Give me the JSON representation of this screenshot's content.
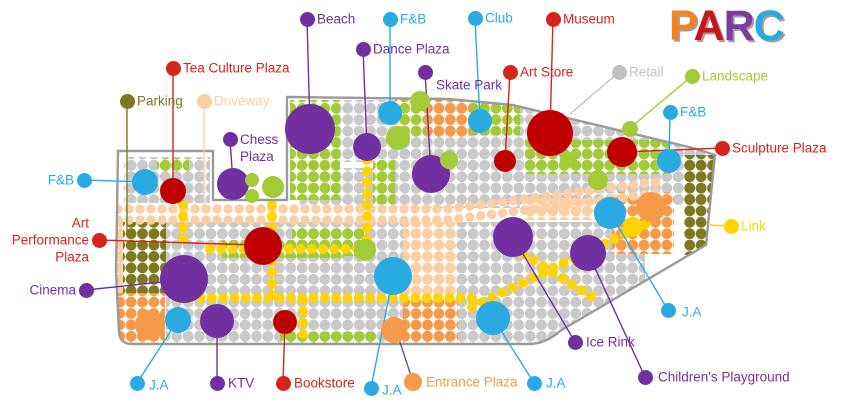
{
  "page": {
    "width": 850,
    "height": 406,
    "background": "#ffffff"
  },
  "logo": {
    "title": "PARC",
    "letters": [
      {
        "ch": "P",
        "color": "#f58220"
      },
      {
        "ch": "A",
        "color": "#c4161c"
      },
      {
        "ch": "R",
        "color": "#7a3c9f"
      },
      {
        "ch": "C",
        "color": "#29abe2"
      }
    ]
  },
  "palette": {
    "purple": "#7030a0",
    "blue": "#29abe2",
    "red": "#d6231d",
    "darkred": "#c00000",
    "olive": "#7d791e",
    "peach": "#fbcfa4",
    "orange": "#f59a49",
    "gray": "#c9c9c9",
    "graytext": "#c1c1c1",
    "green": "#a2cb37",
    "yellow": "#ffd400",
    "outline": "#9b9b9b",
    "slate": "#5c5c8e"
  },
  "map": {
    "outline_path": "M287,97 L448,99 L513,105 L693,148 L715,155 L706,245 L560,331 Q546,344 528,344 L132,344 Q120,344 119,332 L116,272 L118,151 L213,151 L213,200 L287,200 Z",
    "regions": [
      {
        "c": "gray",
        "r": [
          124,
          157,
          86,
          46
        ]
      },
      {
        "c": "gray",
        "r": [
          337,
          100,
          60,
          62
        ]
      },
      {
        "c": "gray",
        "r": [
          300,
          168,
          96,
          38
        ]
      },
      {
        "c": "gray",
        "r": [
          395,
          133,
          125,
          75
        ]
      },
      {
        "c": "gray",
        "r": [
          520,
          95,
          185,
          110
        ]
      },
      {
        "c": "gray",
        "r": [
          166,
          222,
          80,
          122
        ]
      },
      {
        "c": "gray",
        "r": [
          246,
          222,
          157,
          40
        ]
      },
      {
        "c": "gray",
        "r": [
          362,
          258,
          42,
          86
        ]
      },
      {
        "c": "gray",
        "r": [
          244,
          258,
          158,
          86
        ]
      },
      {
        "c": "gray",
        "r": [
          455,
          222,
          190,
          122
        ]
      },
      {
        "c": "green",
        "r": [
          290,
          100,
          50,
          100
        ]
      },
      {
        "c": "green",
        "r": [
          157,
          158,
          32,
          14
        ]
      },
      {
        "c": "green",
        "r": [
          395,
          95,
          30,
          42
        ]
      },
      {
        "c": "green",
        "r": [
          470,
          97,
          50,
          38
        ]
      },
      {
        "c": "green",
        "r": [
          525,
          140,
          145,
          34
        ]
      },
      {
        "c": "green",
        "r": [
          373,
          160,
          22,
          44
        ]
      },
      {
        "c": "green",
        "r": [
          292,
          228,
          72,
          28
        ]
      },
      {
        "c": "green",
        "r": [
          222,
          240,
          122,
          18
        ]
      },
      {
        "c": "green",
        "r": [
          280,
          332,
          96,
          12
        ]
      },
      {
        "c": "olive",
        "r": [
          120,
          222,
          46,
          72
        ]
      },
      {
        "c": "olive",
        "r": [
          684,
          155,
          33,
          100
        ]
      },
      {
        "c": "peach",
        "r": [
          403,
          222,
          54,
          80
        ]
      },
      {
        "c": "peach",
        "r": [
          525,
          198,
          85,
          22
        ]
      },
      {
        "c": "peach",
        "r": [
          97,
          222,
          26,
          72
        ]
      },
      {
        "c": "orange",
        "r": [
          425,
          95,
          46,
          42
        ]
      },
      {
        "c": "orange",
        "r": [
          403,
          300,
          55,
          44
        ]
      },
      {
        "c": "orange",
        "r": [
          612,
          192,
          62,
          62
        ]
      },
      {
        "c": "orange",
        "r": [
          110,
          293,
          55,
          52
        ]
      }
    ],
    "driveway_paths": [
      {
        "d": "M118,209 L448,209 L663,181",
        "w": 9.5
      },
      {
        "d": "M118,220 L448,220 L665,192",
        "w": 9.5
      }
    ],
    "road_paths": [
      {
        "d": "M178,298 H472",
        "w": 10
      },
      {
        "d": "M210,249 H364",
        "w": 10
      },
      {
        "d": "M367,160 V258",
        "w": 10
      },
      {
        "d": "M272,205 V300",
        "w": 10
      },
      {
        "d": "M183,205 V250",
        "w": 10
      },
      {
        "d": "M303,300 V340",
        "w": 10
      },
      {
        "d": "M472,307 L648,223",
        "w": 10
      },
      {
        "d": "M505,242 L600,302",
        "w": 10
      }
    ],
    "markers": [
      {
        "n": "beach-circle",
        "c": "purple",
        "x": 310,
        "y": 129,
        "r": 25
      },
      {
        "n": "dance-plaza-circle",
        "c": "purple",
        "x": 367,
        "y": 147,
        "r": 14
      },
      {
        "n": "skate-park-circle",
        "c": "purple",
        "x": 431,
        "y": 174,
        "r": 19
      },
      {
        "n": "chess-plaza-circle",
        "c": "purple",
        "x": 233,
        "y": 184,
        "r": 16
      },
      {
        "n": "cinema-circle",
        "c": "purple",
        "x": 184,
        "y": 279,
        "r": 24
      },
      {
        "n": "ktv-circle",
        "c": "purple",
        "x": 217,
        "y": 321,
        "r": 17
      },
      {
        "n": "ice-rink-circle",
        "c": "purple",
        "x": 513,
        "y": 237,
        "r": 20
      },
      {
        "n": "childrens-playground-circle",
        "c": "purple",
        "x": 588,
        "y": 253,
        "r": 18
      },
      {
        "n": "green-circle",
        "c": "green",
        "x": 398,
        "y": 138,
        "r": 12
      },
      {
        "n": "green-circle",
        "c": "green",
        "x": 449,
        "y": 160,
        "r": 9
      },
      {
        "n": "green-circle",
        "c": "green",
        "x": 420,
        "y": 101,
        "r": 10
      },
      {
        "n": "green-circle",
        "c": "green",
        "x": 365,
        "y": 250,
        "r": 11
      },
      {
        "n": "green-circle",
        "c": "green",
        "x": 252,
        "y": 180,
        "r": 7
      },
      {
        "n": "green-circle",
        "c": "green",
        "x": 252,
        "y": 196,
        "r": 7
      },
      {
        "n": "green-circle",
        "c": "green",
        "x": 273,
        "y": 187,
        "r": 11
      },
      {
        "n": "green-circle",
        "c": "green",
        "x": 630,
        "y": 129,
        "r": 8
      },
      {
        "n": "green-circle",
        "c": "green",
        "x": 598,
        "y": 180,
        "r": 10
      },
      {
        "n": "green-circle",
        "c": "green",
        "x": 568,
        "y": 160,
        "r": 8
      },
      {
        "n": "museum-circle",
        "c": "darkred",
        "x": 550,
        "y": 133,
        "r": 23
      },
      {
        "n": "tea-culture-circle",
        "c": "darkred",
        "x": 173,
        "y": 191,
        "r": 13
      },
      {
        "n": "art-store-circle",
        "c": "darkred",
        "x": 505,
        "y": 161,
        "r": 11
      },
      {
        "n": "sculpture-circle",
        "c": "darkred",
        "x": 622,
        "y": 152,
        "r": 15
      },
      {
        "n": "art-performance-circle",
        "c": "darkred",
        "x": 263,
        "y": 246,
        "r": 19
      },
      {
        "n": "bookstore-circle",
        "c": "darkred",
        "x": 285,
        "y": 322,
        "r": 12
      },
      {
        "n": "entrance-circle",
        "c": "orange",
        "x": 394,
        "y": 330,
        "r": 13
      },
      {
        "n": "orange-circle",
        "c": "orange",
        "x": 651,
        "y": 207,
        "r": 15
      },
      {
        "n": "orange-circle",
        "c": "orange",
        "x": 150,
        "y": 325,
        "r": 15
      },
      {
        "n": "link-circle",
        "c": "yellow",
        "x": 633,
        "y": 227,
        "r": 10
      },
      {
        "n": "fnb-top-circle",
        "c": "blue",
        "x": 390,
        "y": 113,
        "r": 12
      },
      {
        "n": "club-circle",
        "c": "blue",
        "x": 480,
        "y": 121,
        "r": 12
      },
      {
        "n": "fnb-left-circle",
        "c": "blue",
        "x": 145,
        "y": 182,
        "r": 13
      },
      {
        "n": "fnb-right-circle",
        "c": "blue",
        "x": 669,
        "y": 161,
        "r": 12
      },
      {
        "n": "ja-circle",
        "c": "blue",
        "x": 178,
        "y": 320,
        "r": 13
      },
      {
        "n": "ja-circle",
        "c": "blue",
        "x": 393,
        "y": 276,
        "r": 19
      },
      {
        "n": "ja-circle",
        "c": "blue",
        "x": 493,
        "y": 318,
        "r": 17
      },
      {
        "n": "ja-circle",
        "c": "blue",
        "x": 610,
        "y": 213,
        "r": 16
      }
    ],
    "labels": [
      {
        "id": "beach",
        "lines": [
          "Beach"
        ],
        "color": "purple",
        "dot": [
          307,
          19
        ],
        "tx": 317,
        "ty": 19,
        "align": "left",
        "target": [
          310,
          129
        ]
      },
      {
        "id": "fnb-top",
        "lines": [
          "F&B"
        ],
        "color": "blue",
        "dot": [
          390,
          19
        ],
        "tx": 400,
        "ty": 19,
        "align": "left",
        "target": [
          390,
          113
        ]
      },
      {
        "id": "club",
        "lines": [
          "Club"
        ],
        "color": "blue",
        "dot": [
          475,
          18
        ],
        "tx": 485,
        "ty": 18,
        "align": "left",
        "target": [
          480,
          121
        ]
      },
      {
        "id": "museum",
        "lines": [
          "Museum"
        ],
        "color": "red",
        "dot": [
          553,
          19
        ],
        "tx": 563,
        "ty": 19,
        "align": "left",
        "target": [
          550,
          133
        ]
      },
      {
        "id": "dance-plaza",
        "lines": [
          "Dance Plaza"
        ],
        "color": "purple",
        "dot": [
          363,
          49
        ],
        "tx": 373,
        "ty": 49,
        "align": "left",
        "target": [
          367,
          147
        ]
      },
      {
        "id": "skate-park",
        "lines": [
          "Skate Park"
        ],
        "color": "purple",
        "dot": [
          425,
          72
        ],
        "tx": 436,
        "ty": 85,
        "align": "left",
        "target": [
          431,
          174
        ]
      },
      {
        "id": "tea-culture-plaza",
        "lines": [
          "Tea Culture Plaza"
        ],
        "color": "red",
        "dot": [
          173,
          68
        ],
        "tx": 183,
        "ty": 68,
        "align": "left",
        "target": [
          173,
          190
        ]
      },
      {
        "id": "art-store",
        "lines": [
          "Art Store"
        ],
        "color": "red",
        "dot": [
          510,
          72
        ],
        "tx": 520,
        "ty": 72,
        "align": "left",
        "target": [
          505,
          161
        ]
      },
      {
        "id": "parking",
        "lines": [
          "Parking"
        ],
        "color": "olive",
        "dot": [
          127,
          101
        ],
        "tx": 137,
        "ty": 101,
        "align": "left",
        "target": [
          127,
          235
        ]
      },
      {
        "id": "driveway",
        "lines": [
          "Driveway"
        ],
        "color": "peach",
        "dot": [
          204,
          101
        ],
        "tx": 214,
        "ty": 101,
        "align": "left",
        "target": [
          204,
          213
        ]
      },
      {
        "id": "chess-plaza",
        "lines": [
          "Chess",
          "Plaza"
        ],
        "color": "purple",
        "dot": [
          230,
          139
        ],
        "tx": 240,
        "ty": 148,
        "align": "left",
        "target": [
          233,
          183
        ]
      },
      {
        "id": "retail",
        "lines": [
          "Retail"
        ],
        "color": "graytext",
        "dot": [
          619,
          72
        ],
        "tx": 629,
        "ty": 72,
        "align": "left",
        "target": [
          570,
          114
        ]
      },
      {
        "id": "landscape",
        "lines": [
          "Landscape"
        ],
        "color": "green",
        "dot": [
          692,
          76
        ],
        "tx": 702,
        "ty": 76,
        "align": "left",
        "target": [
          630,
          128
        ]
      },
      {
        "id": "fnb-right",
        "lines": [
          "F&B"
        ],
        "color": "blue",
        "dot": [
          670,
          112
        ],
        "tx": 680,
        "ty": 112,
        "align": "left",
        "target": [
          669,
          160
        ]
      },
      {
        "id": "sculpture-plaza",
        "lines": [
          "Sculpture Plaza"
        ],
        "color": "red",
        "dot": [
          722,
          148
        ],
        "tx": 732,
        "ty": 148,
        "align": "left",
        "target": [
          624,
          152
        ]
      },
      {
        "id": "fnb-left",
        "lines": [
          "F&B"
        ],
        "color": "blue",
        "dot": [
          84,
          180
        ],
        "tx": 74,
        "ty": 180,
        "align": "right",
        "target": [
          145,
          182
        ]
      },
      {
        "id": "art-performance-plaza",
        "lines": [
          "Art",
          "Performance",
          "Plaza"
        ],
        "color": "red",
        "dot": [
          99,
          240
        ],
        "tx": 89,
        "ty": 240,
        "align": "right",
        "target": [
          255,
          245
        ]
      },
      {
        "id": "cinema",
        "lines": [
          "Cinema"
        ],
        "color": "purple",
        "dot": [
          86,
          290
        ],
        "tx": 76,
        "ty": 290,
        "align": "right",
        "target": [
          180,
          280
        ]
      },
      {
        "id": "link",
        "lines": [
          "Link"
        ],
        "color": "yellow",
        "dot": [
          731,
          226
        ],
        "tx": 741,
        "ty": 226,
        "align": "left",
        "target": [
          710,
          225
        ]
      },
      {
        "id": "ja-right",
        "lines": [
          "J.A"
        ],
        "color": "blue",
        "dot": [
          668,
          310
        ],
        "tx": 682,
        "ty": 312,
        "align": "left",
        "target": [
          610,
          213
        ]
      },
      {
        "id": "ice-rink",
        "lines": [
          "Ice Rink"
        ],
        "color": "purple",
        "dot": [
          575,
          342
        ],
        "tx": 586,
        "ty": 342,
        "align": "left",
        "target": [
          513,
          237
        ]
      },
      {
        "id": "childrens-playground",
        "lines": [
          "Children's Playground"
        ],
        "color": "purple",
        "dot": [
          645,
          377
        ],
        "tx": 658,
        "ty": 377,
        "align": "left",
        "target": [
          588,
          253
        ]
      },
      {
        "id": "ja-bottom-left",
        "lines": [
          "J.A"
        ],
        "color": "blue",
        "dot": [
          137,
          383
        ],
        "tx": 149,
        "ty": 385,
        "align": "left",
        "target": [
          178,
          320
        ]
      },
      {
        "id": "ktv",
        "lines": [
          "KTV"
        ],
        "color": "purple",
        "dot": [
          217,
          383
        ],
        "tx": 228,
        "ty": 383,
        "align": "left",
        "target": [
          217,
          321
        ]
      },
      {
        "id": "bookstore",
        "lines": [
          "Bookstore"
        ],
        "color": "red",
        "dot": [
          283,
          383
        ],
        "tx": 294,
        "ty": 383,
        "align": "left",
        "target": [
          285,
          322
        ]
      },
      {
        "id": "ja-bottom-mid",
        "lines": [
          "J.A"
        ],
        "color": "blue",
        "dot": [
          371,
          388
        ],
        "tx": 382,
        "ty": 390,
        "align": "left",
        "target": [
          393,
          276
        ]
      },
      {
        "id": "entrance-plaza",
        "lines": [
          "Entrance Plaza"
        ],
        "color": "orange",
        "dot": [
          413,
          382
        ],
        "tx": 426,
        "ty": 382,
        "align": "left",
        "target": [
          397,
          333
        ],
        "line_color": "slate",
        "dot_size": 18
      },
      {
        "id": "ja-bottom-right",
        "lines": [
          "J.A"
        ],
        "color": "blue",
        "dot": [
          534,
          383
        ],
        "tx": 546,
        "ty": 383,
        "align": "left",
        "target": [
          493,
          318
        ]
      }
    ]
  }
}
